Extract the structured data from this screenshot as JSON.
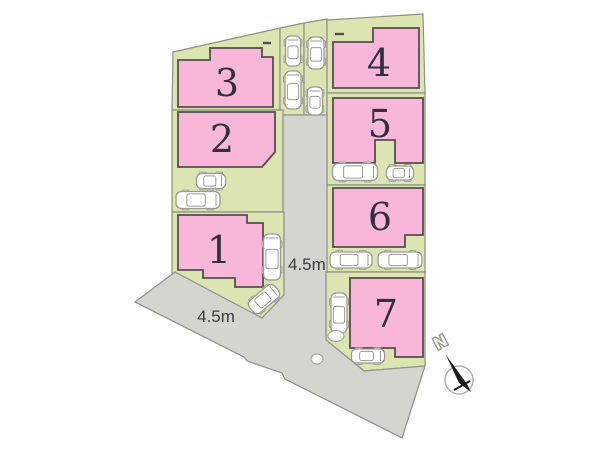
{
  "scene": {
    "width": 600,
    "height": 450
  },
  "colors": {
    "background": "#ffffff",
    "lot_fill": "#dce4b2",
    "lot_stroke": "#8f8f84",
    "road_fill": "#d5d5d0",
    "road_stroke": "#95958c",
    "building_fill": "#f8b6d8",
    "building_stroke": "#524f4e",
    "number_color": "#30303f",
    "label_color": "#3a3a3a",
    "car_fill": "#ffffff",
    "car_stroke": "#9b9b93",
    "marker_fill": "#fbfbf4",
    "marker_stroke": "#aaaaa2",
    "compass_needle": "#1b1b1b",
    "compass_circle": "#b1b1a9",
    "north_fill": "#f8f8f4",
    "north_stroke": "#97978e"
  },
  "parcels": [
    {
      "id": "lot-3",
      "points": "173,52 280,28 280,110 172,110"
    },
    {
      "id": "strip-a",
      "points": "280,28 304,23 304,115 280,115"
    },
    {
      "id": "strip-b",
      "points": "304,23 327,19 327,115 304,115"
    },
    {
      "id": "lot-2",
      "points": "172,110 283,110 283,212 172,212"
    },
    {
      "id": "lot-1",
      "points": "172,212 284,212 284,295 262,318 172,273"
    },
    {
      "id": "lot-4",
      "points": "327,20 423,14 425,93 327,93"
    },
    {
      "id": "lot-5",
      "points": "327,93 425,93 425,185 327,185"
    },
    {
      "id": "lot-6",
      "points": "327,185 425,185 425,272 326,272"
    },
    {
      "id": "lot-7",
      "points": "326,272 425,272 425,366 364,371 326,340"
    }
  ],
  "road": {
    "points": "283,115 327,115 327,272 326,272 326,340 364,371 425,366 402,438 285,379 282,373 247,361 244,357 135,302 175,272 262,318 284,295 284,212 283,212"
  },
  "buildings": [
    {
      "number": "3",
      "points": "178,60 210,60 210,48 262,48 262,57 273,57 273,107 178,107",
      "label_x": 227,
      "label_y": 83
    },
    {
      "number": "2",
      "points": "178,112 275,112 275,152 262,167 178,167",
      "label_x": 222,
      "label_y": 139
    },
    {
      "number": "1",
      "points": "178,215 247,215 247,223 263,223 263,287 235,287 235,278 203,278 203,270 178,270",
      "label_x": 219,
      "label_y": 250
    },
    {
      "number": "4",
      "points": "333,42 373,42 373,28 419,28 419,88 333,88",
      "label_x": 379,
      "label_y": 63
    },
    {
      "number": "5",
      "points": "333,98 423,98 423,163 395,163 395,140 375,140 375,163 333,163",
      "label_x": 380,
      "label_y": 124
    },
    {
      "number": "6",
      "points": "333,188 423,188 423,235 405,235 405,247 333,247",
      "label_x": 380,
      "label_y": 217
    },
    {
      "number": "7",
      "points": "350,278 423,278 423,357 395,357 395,348 350,348",
      "label_x": 386,
      "label_y": 314
    }
  ],
  "cars": [
    {
      "x": 293,
      "y": 51,
      "len": 30,
      "wid": 15,
      "angle": 0
    },
    {
      "x": 293,
      "y": 90,
      "len": 38,
      "wid": 16,
      "angle": 0
    },
    {
      "x": 316,
      "y": 53,
      "len": 32,
      "wid": 16,
      "angle": 0
    },
    {
      "x": 315,
      "y": 101,
      "len": 28,
      "wid": 15,
      "angle": 0
    },
    {
      "x": 211,
      "y": 181,
      "len": 29,
      "wid": 15,
      "angle": 90
    },
    {
      "x": 198,
      "y": 200,
      "len": 44,
      "wid": 17,
      "angle": 90
    },
    {
      "x": 272,
      "y": 257,
      "len": 46,
      "wid": 17,
      "angle": 0
    },
    {
      "x": 264,
      "y": 299,
      "len": 33,
      "wid": 16,
      "angle": 50
    },
    {
      "x": 355,
      "y": 172,
      "len": 45,
      "wid": 17,
      "angle": 90
    },
    {
      "x": 400,
      "y": 173,
      "len": 27,
      "wid": 14,
      "angle": 90
    },
    {
      "x": 351,
      "y": 260,
      "len": 42,
      "wid": 16,
      "angle": 90
    },
    {
      "x": 400,
      "y": 260,
      "len": 44,
      "wid": 16,
      "angle": 90
    },
    {
      "x": 339,
      "y": 313,
      "len": 40,
      "wid": 16,
      "angle": 0
    },
    {
      "x": 368,
      "y": 356,
      "len": 33,
      "wid": 14,
      "angle": 90
    }
  ],
  "markers": [
    {
      "cx": 336,
      "cy": 336,
      "rx": 8,
      "ry": 5.5
    },
    {
      "cx": 317,
      "cy": 359,
      "rx": 6,
      "ry": 5
    }
  ],
  "wall_marks": [
    {
      "x1": 335,
      "y1": 34,
      "x2": 344,
      "y2": 34
    },
    {
      "x1": 263,
      "y1": 43,
      "x2": 271,
      "y2": 43
    }
  ],
  "labels": {
    "road_width_right": {
      "text": "4.5m",
      "x": 288,
      "y": 270
    },
    "road_width_bottom": {
      "text": "4.5m",
      "x": 216,
      "y": 322
    }
  },
  "compass": {
    "label": "N",
    "cx": 459,
    "cy": 380,
    "r": 14,
    "needle_points": "446,355 467,384 471,392 459,383",
    "cross": {
      "x1": 454,
      "y1": 390,
      "x2": 470,
      "y2": 381
    },
    "label_x": 443,
    "label_y": 347,
    "label_rotate": -28
  }
}
